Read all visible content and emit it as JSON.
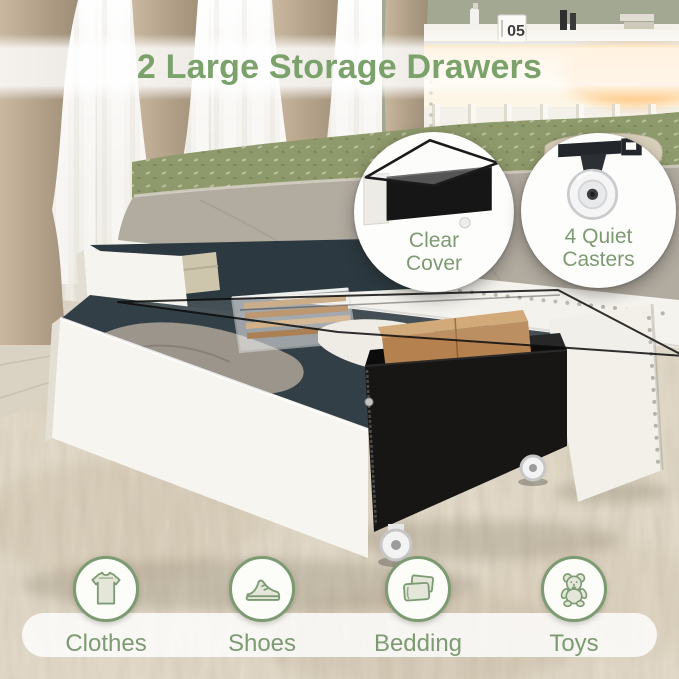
{
  "title": "2 Large Storage Drawers",
  "callouts": {
    "clear_cover": {
      "line1": "Clear",
      "line2": "Cover"
    },
    "casters": {
      "line1": "4 Quiet",
      "line2": "Casters"
    }
  },
  "categories": [
    {
      "label": "Clothes",
      "icon": "tshirt-icon"
    },
    {
      "label": "Shoes",
      "icon": "shoe-icon"
    },
    {
      "label": "Bedding",
      "icon": "bedding-icon"
    },
    {
      "label": "Toys",
      "icon": "teddy-bear-icon"
    }
  ],
  "scene": {
    "headboard_clock": "05"
  },
  "colors": {
    "accent_green": "#7ca26c",
    "label_green": "#7d9b72",
    "wall_sage": "#a2a892"
  }
}
